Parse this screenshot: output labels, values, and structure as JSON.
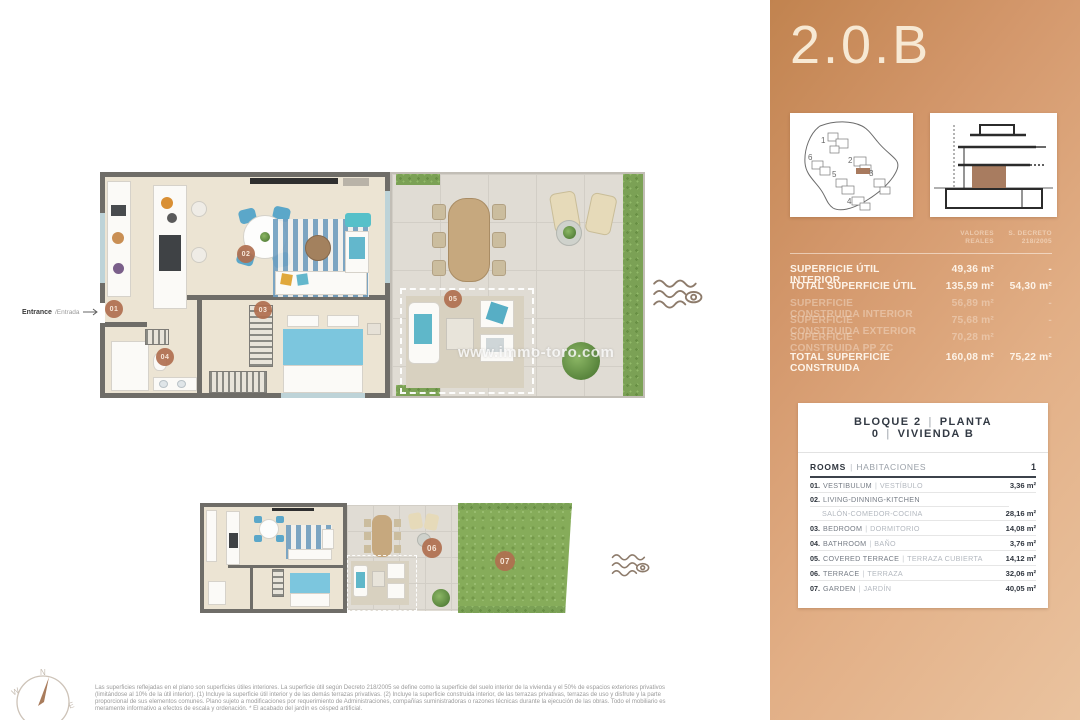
{
  "sidebar": {
    "title": "2.0.B",
    "thumbs": {
      "numbers": [
        "1",
        "2",
        "3",
        "4",
        "5",
        "6"
      ]
    },
    "surface": {
      "col1_line1": "VALORES",
      "col1_line2": "REALES",
      "col2_line1": "S. DECRETO",
      "col2_line2": "218/2005",
      "rows": [
        {
          "label": "SUPERFICIE ÚTIL INTERIOR",
          "real": "49,36 m²",
          "dec": "-"
        },
        {
          "label": "TOTAL SUPERFICIE ÚTIL",
          "real": "135,59 m²",
          "dec": "54,30 m²"
        },
        {
          "label": "SUPERFICIE CONSTRUIDA INTERIOR",
          "real": "56,89 m²",
          "dec": "-"
        },
        {
          "label": "SUPERFICIE CONSTRUIDA EXTERIOR",
          "real": "75,68 m²",
          "dec": "-"
        },
        {
          "label": "SUPERFICIE CONSTRUIDA PP ZC",
          "real": "70,28 m²",
          "dec": "-"
        },
        {
          "label": "TOTAL SUPERFICIE CONSTRUIDA",
          "real": "160,08 m²",
          "dec": "75,22 m²"
        }
      ]
    },
    "unit": {
      "header_parts": [
        "BLOQUE 2",
        "PLANTA 0",
        "VIVIENDA B"
      ],
      "sep": "|",
      "rooms_en": "ROOMS",
      "rooms_es": "HABITACIONES",
      "rooms_count": "1",
      "rows": [
        {
          "num": "01.",
          "en": "VESTIBULUM",
          "es": "VESTÍBULO",
          "area": "3,36 m²"
        },
        {
          "num": "02.",
          "en": "LIVING-DINNING-KITCHEN",
          "es": "SALÓN-COMEDOR-COCINA",
          "area": "28,16 m²"
        },
        {
          "num": "03.",
          "en": "BEDROOM",
          "es": "DORMITORIO",
          "area": "14,08 m²"
        },
        {
          "num": "04.",
          "en": "BATHROOM",
          "es": "BAÑO",
          "area": "3,76 m²"
        },
        {
          "num": "05.",
          "en": "COVERED TERRACE",
          "es": "TERRAZA CUBIERTA",
          "area": "14,12 m²"
        },
        {
          "num": "06.",
          "en": "TERRACE",
          "es": "TERRAZA",
          "area": "32,06 m²"
        },
        {
          "num": "07.",
          "en": "GARDEN",
          "es": "JARDÍN",
          "area": "40,05 m²"
        }
      ]
    }
  },
  "plan": {
    "entrance_bold": "Entrance",
    "entrance_light": "/Entrada",
    "watermark": "www.immo-toro.com",
    "badges": [
      "01",
      "02",
      "03",
      "04",
      "05",
      "06",
      "07"
    ],
    "compass": {
      "n": "N",
      "w": "W",
      "e": "E"
    }
  },
  "footer": {
    "lines": [
      "Las superficies reflejadas en el plano son superficies útiles interiores. La superficie útil según Decreto 218/2005 se define como la superficie del suelo interior de la vivienda y el 50% de espacios exteriores privativos",
      "(limitándose al 10% de la útil interior). (1) Incluye la superficie útil interior y de las demás terrazas privativas. (2) Incluye la superficie construida interior, de las terrazas privativas, terrazas de uso y disfrute y la parte",
      "proporcional de sus elementos comunes. Plano sujeto a modificaciones por requerimiento de Administraciones, compañías suministradoras o razones técnicas durante la ejecución de las obras. Todo el mobiliario es",
      "meramente informativo a efectos de escala y ordenación. * El acabado del jardín es césped artificial."
    ]
  },
  "colors": {
    "accent_brown": "#a87c60",
    "panel_gradient_dark": "#c1834f",
    "panel_gradient_light": "#eac39f",
    "badge": "#b06f4f",
    "hedge_green": "#7ba155",
    "waves_icon": "#8d7b6b"
  }
}
